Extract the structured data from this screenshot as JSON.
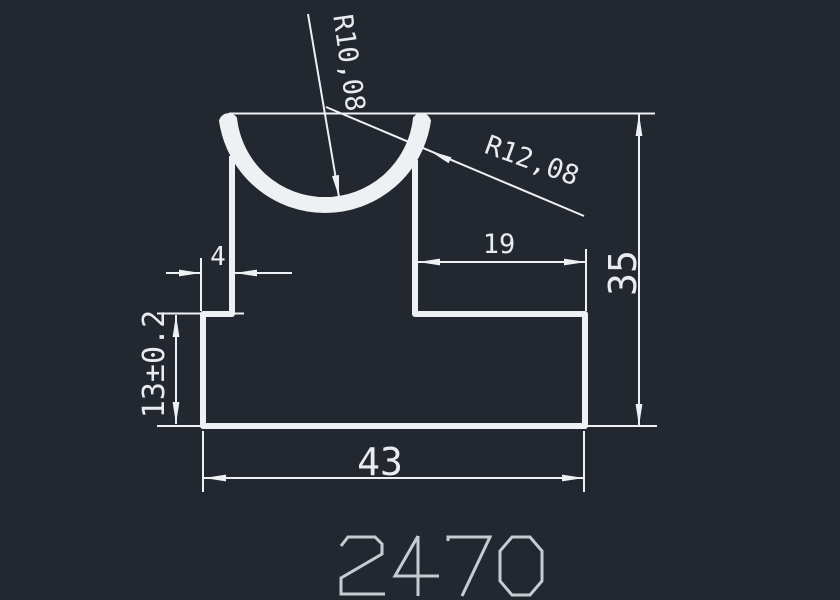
{
  "part_number": "2470",
  "dims": {
    "lip_thickness": "4",
    "right_shoulder_width": "19",
    "total_height": "35",
    "base_height": "13±0.2",
    "base_width": "43",
    "groove_radius_inner": "R10,08",
    "groove_radius_outer": "R12,08"
  },
  "colors": {
    "background": "#232830",
    "line": "#eef1f4",
    "text": "#e9eCef",
    "part_number": "#c7ccd2"
  }
}
